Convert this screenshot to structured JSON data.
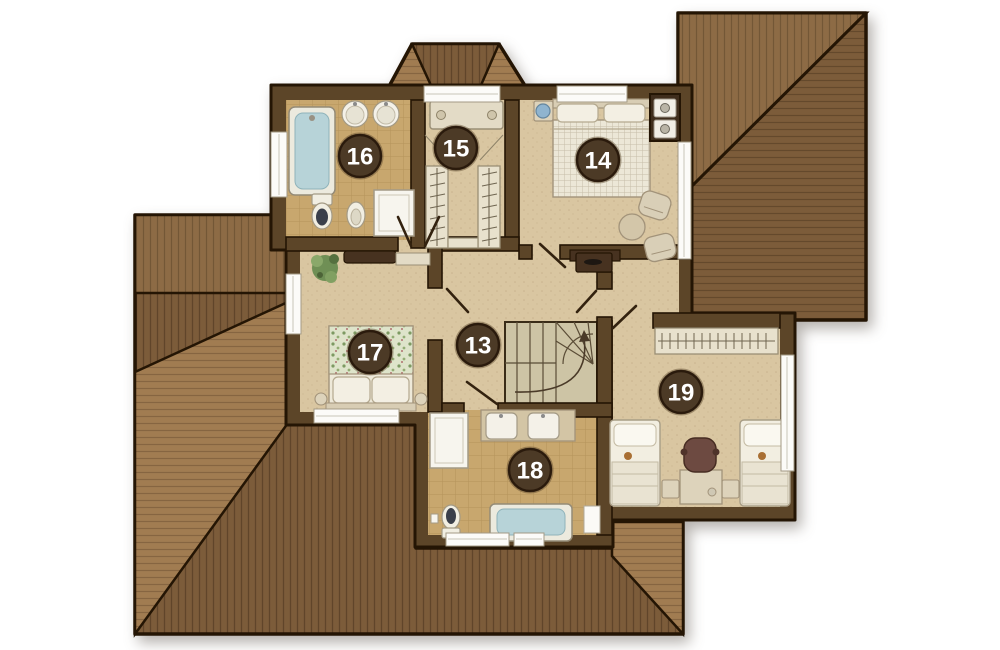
{
  "plan": {
    "rooms": [
      {
        "name": "hallway-landing",
        "label": "13"
      },
      {
        "name": "master-bedroom",
        "label": "14"
      },
      {
        "name": "walk-in-closet",
        "label": "15"
      },
      {
        "name": "ensuite-bathroom",
        "label": "16"
      },
      {
        "name": "bedroom",
        "label": "17"
      },
      {
        "name": "family-bathroom",
        "label": "18"
      },
      {
        "name": "kids-bedroom",
        "label": "19"
      }
    ],
    "colors": {
      "wall": "#5c4528",
      "outline": "#241504",
      "floor": "#d9c6a1",
      "tile": "#c8a76e",
      "stairs-floor": "#cdc4a5",
      "roof-dark": "#7c5c3a",
      "roof-med": "#8d6b45",
      "roof-light": "#a17c51",
      "badge": "#4c3a26",
      "badge-text": "#ffffff",
      "water": "#b7d3d8",
      "furniture": "#f2eee1",
      "wood-dark": "#473220"
    }
  }
}
